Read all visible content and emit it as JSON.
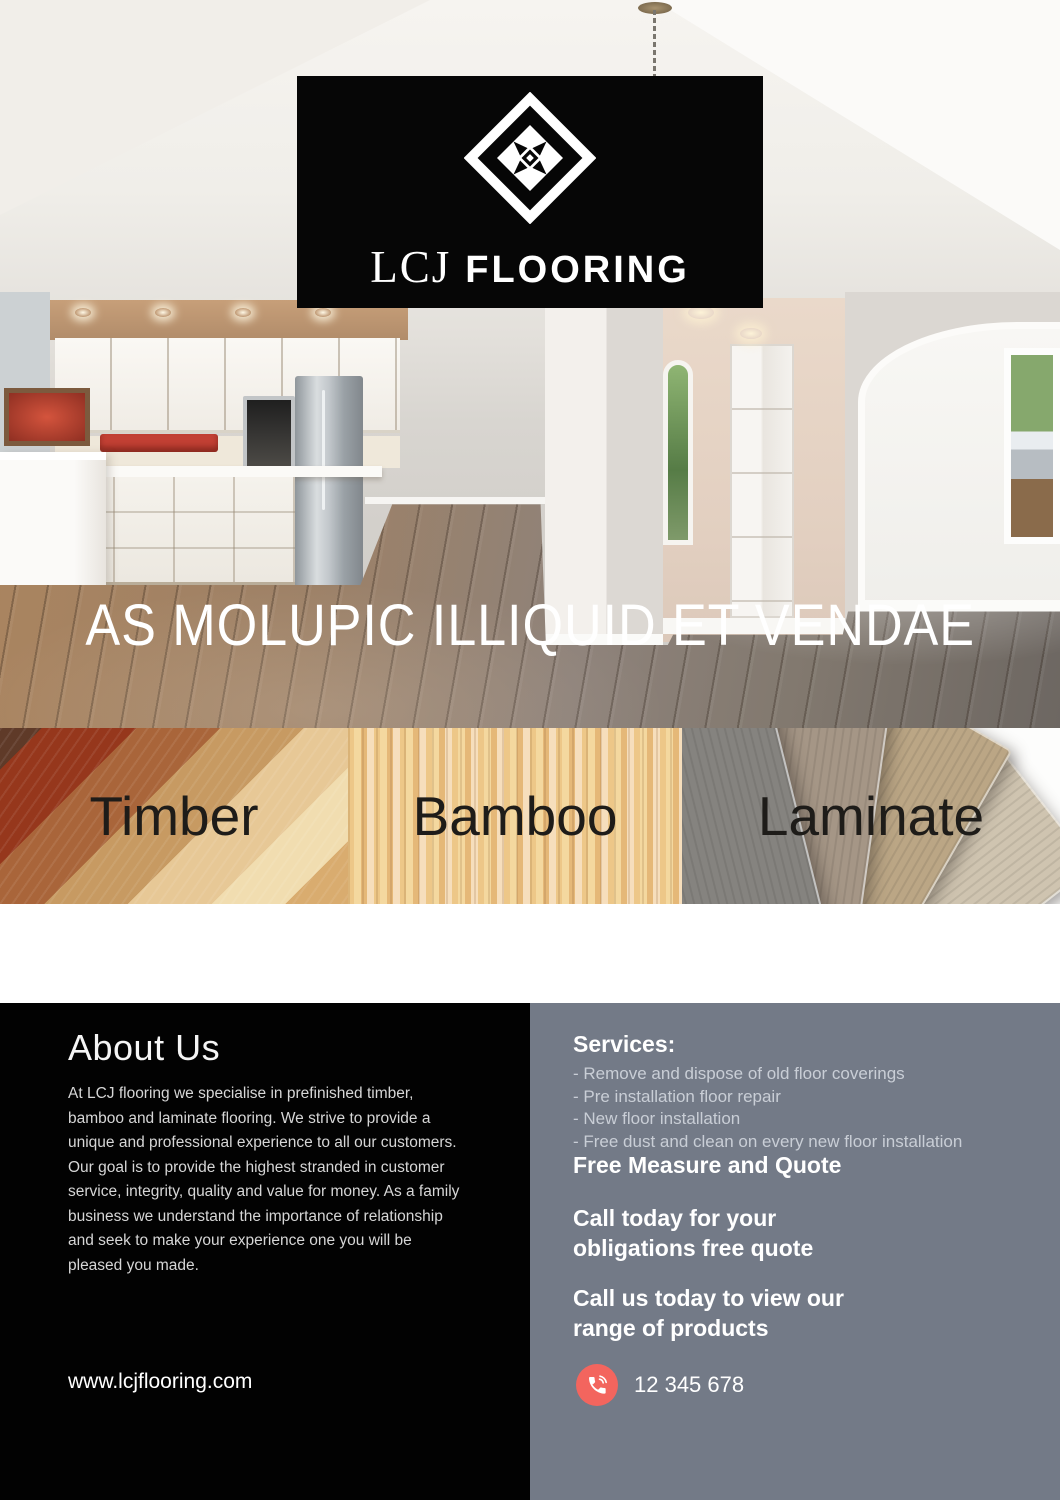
{
  "brand": {
    "logo_serif": "LCJ",
    "logo_sans": "FLOORING"
  },
  "hero": {
    "tagline": "AS MOLUPIC ILLIQUID ET VENDAE"
  },
  "categories": [
    {
      "label": "Timber",
      "description": "Spotted Gum, Eastern States\nBlackbutt, Jarrah, Marri, and a\nlarge collection of French Oak."
    },
    {
      "label": "Bamboo",
      "description": "Our Bamboo range of flooring is\nengineered to withstand the ex-\ntremes of the Australian climate."
    },
    {
      "label": "Laminate",
      "description": "All our laminate range comes\nwith a 25 year product warranty.\nChoose from a large range of\npatterns, colours and finishes."
    }
  ],
  "about": {
    "heading": "About Us",
    "body": "At LCJ flooring we specialise in prefinished timber,\nbamboo and laminate flooring. We strive to provide a\nunique and professional experience to all our customers.\nOur goal is to provide the highest stranded in customer\nservice, integrity, quality and value for money. As a family\nbusiness we understand the importance of relationship\nand seek to make your experience one you will be\npleased you made.",
    "website": "www.lcjflooring.com"
  },
  "services": {
    "heading": "Services:",
    "items": [
      "- Remove and dispose of old floor coverings",
      "- Pre installation floor repair",
      "- New floor installation",
      "- Free dust and clean on every new floor installation"
    ],
    "free_measure": "Free Measure and Quote",
    "call_today": "Call today for your\nobligations free quote",
    "call_view": "Call us today to view our\nrange of products",
    "phone": "12 345 678"
  },
  "colors": {
    "accent_red": "#f3655e",
    "panel_gray": "#737a87",
    "panel_black": "#020202"
  }
}
